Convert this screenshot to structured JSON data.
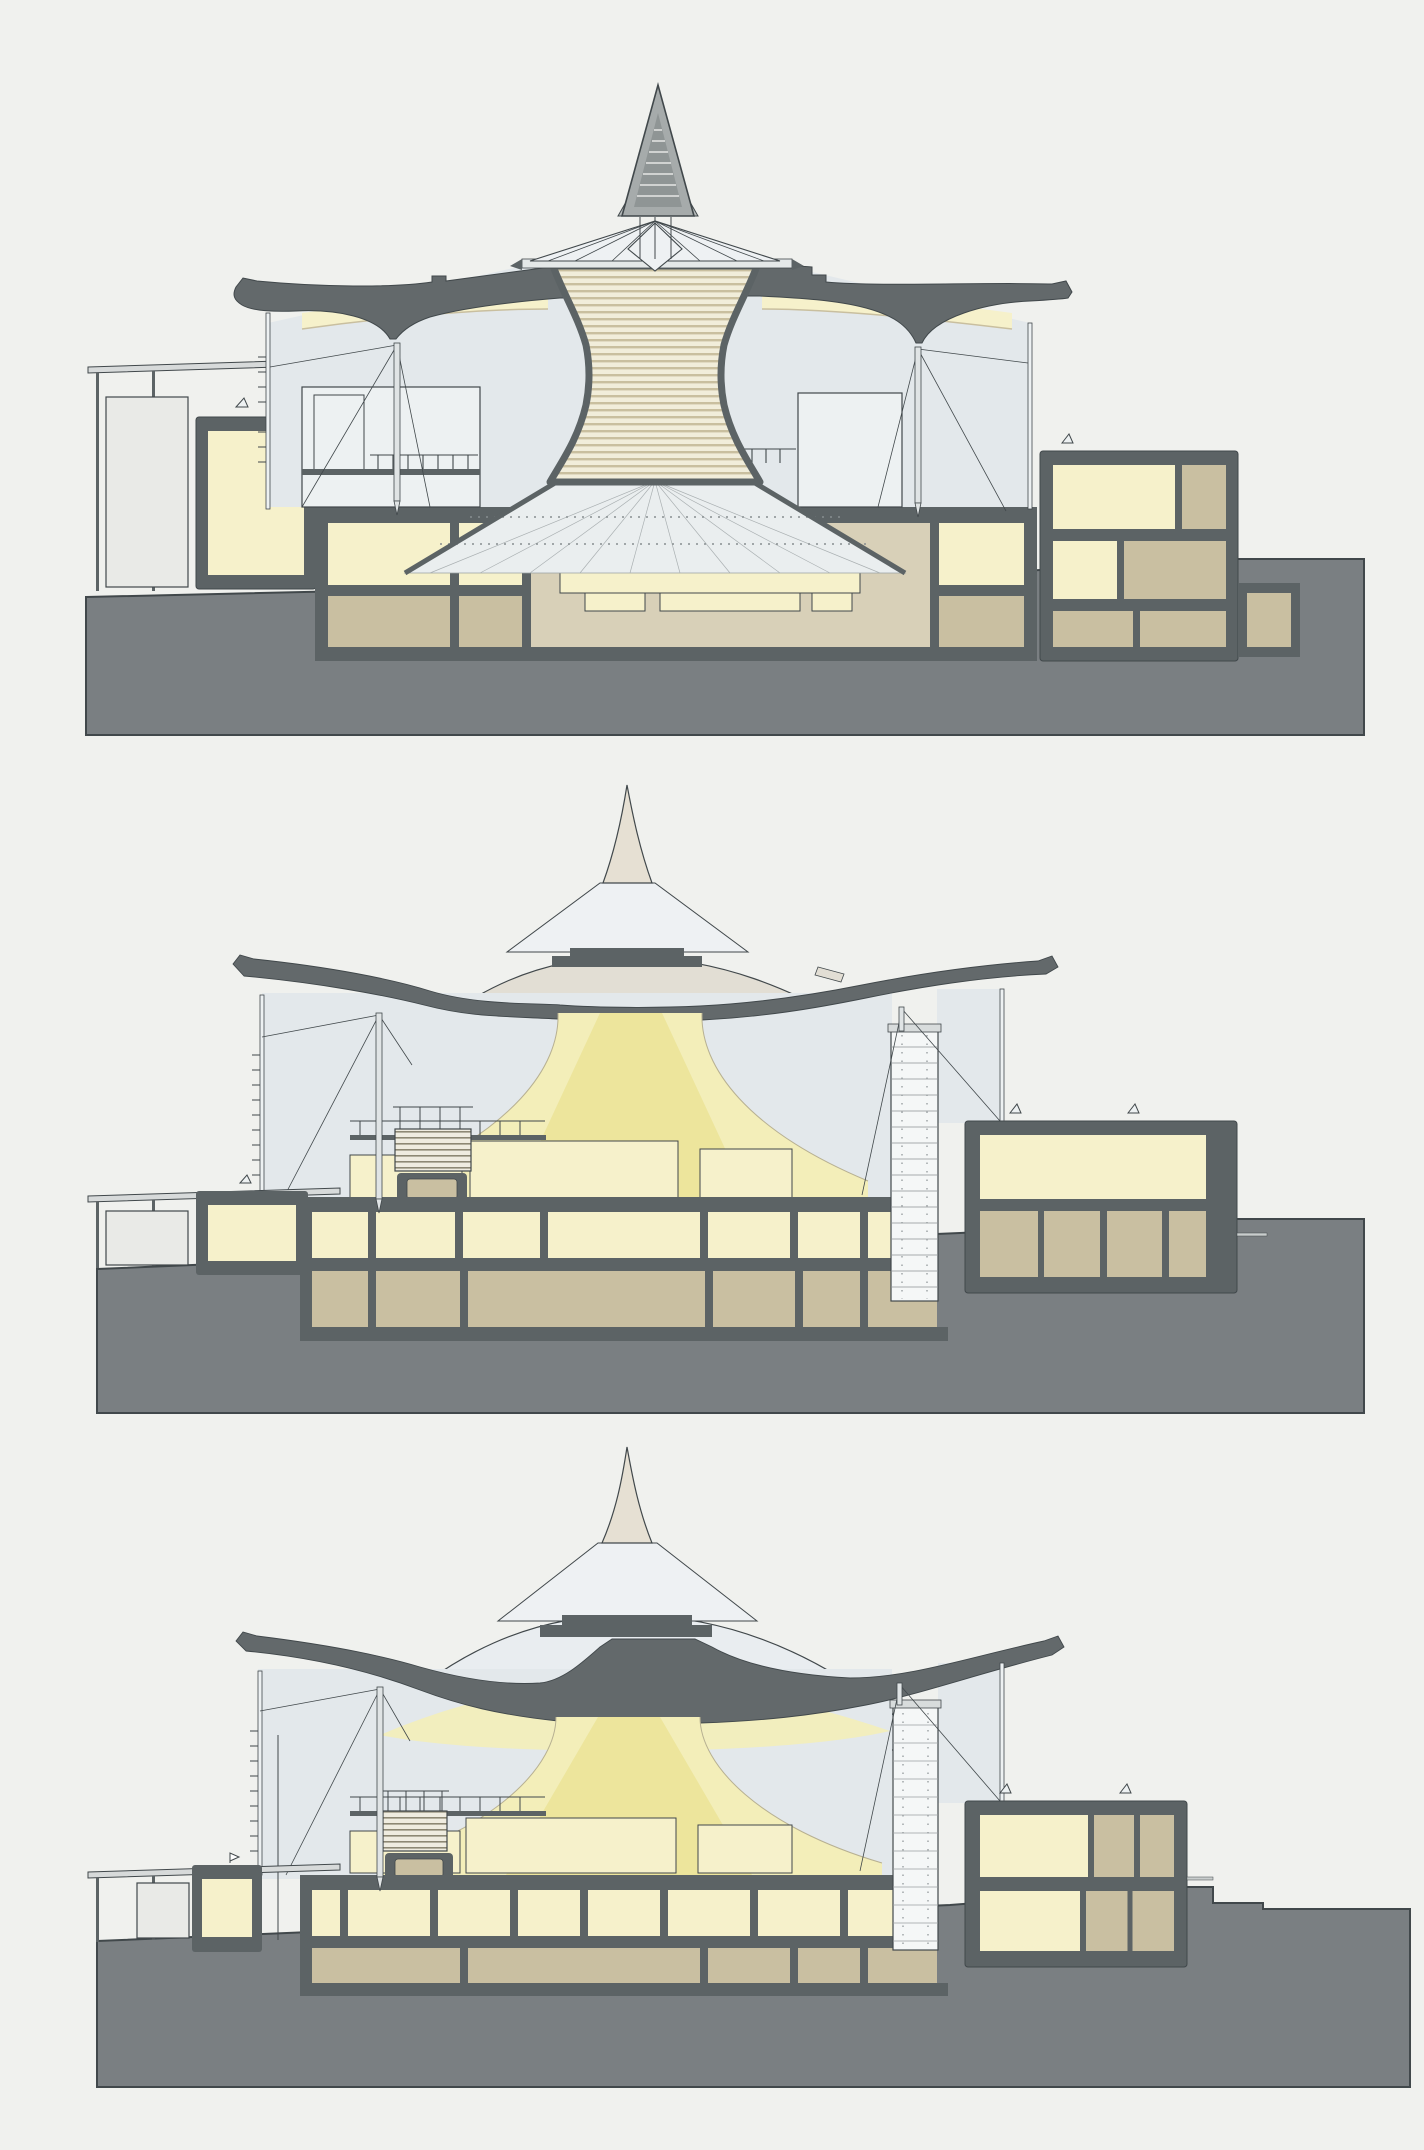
{
  "document": {
    "title": "Tent-roof hall — three sectional drawings"
  },
  "colors": {
    "background": "#f0f1ee",
    "outline": "#41484b",
    "wall": "#5c6365",
    "roofBand": "#63696b",
    "ground": "#7a7f82",
    "roomYellow": "#f6f1cb",
    "glowYellow": "#f3eeb9",
    "glowCore": "#ebe397",
    "basementTan": "#c9bfa1",
    "stageTan": "#d8d0b8",
    "interiorAir": "#e3e8eb",
    "paneLight": "#edf1f2",
    "coneLight": "#eef1f3",
    "tentWarm": "#e2ded4",
    "tentCool": "#e9edf0",
    "spireBeige": "#e6e0d3",
    "spireGray": "#a6abab",
    "spireGrayDark": "#8f9595",
    "skirtGray": "#b6bbbb",
    "stripeBase": "#f1edda",
    "stripeLine": "#c9bf9f",
    "canopyGray": "#d7dada",
    "pavilionGray": "#e9eae7",
    "metalLight": "#e0e4e5",
    "fanFill": "#eaeeef",
    "towerWhite": "#f5f7f7"
  },
  "panels": [
    {
      "id": "section-a",
      "name": "Section 1 — auditorium with louvered funnel and lattice skylight cone"
    },
    {
      "id": "section-b",
      "name": "Section 2 — hall with smooth tent roof and central light funnel"
    },
    {
      "id": "section-c",
      "name": "Section 3 — hall with tent roof, light funnel and terraced ground"
    }
  ]
}
